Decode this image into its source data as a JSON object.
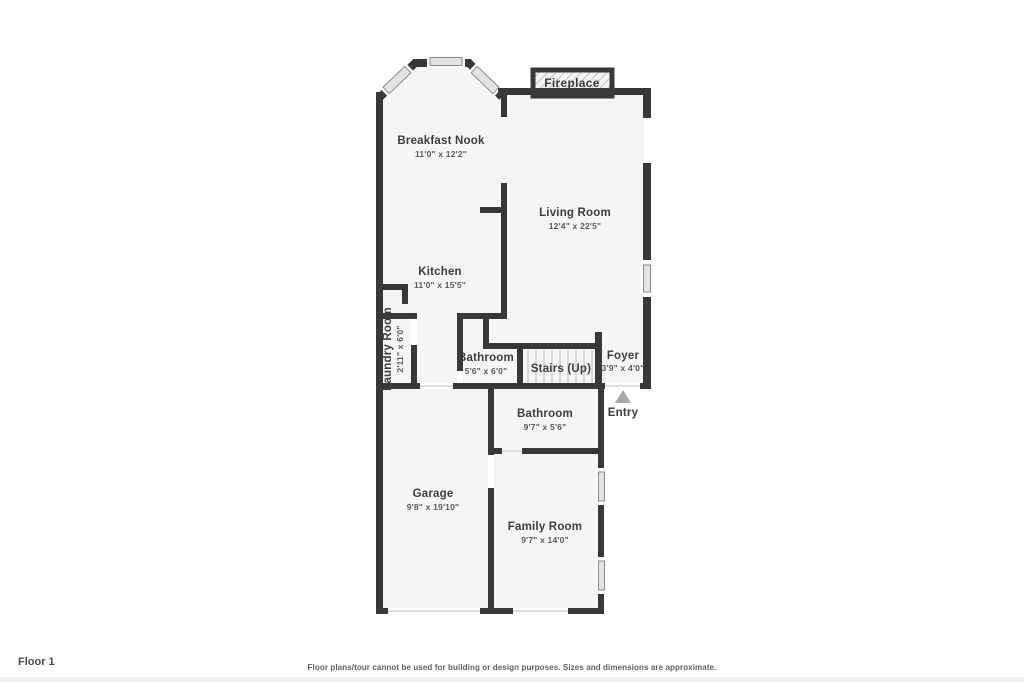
{
  "plan": {
    "floor_label": "Floor 1",
    "disclaimer": "Floor plans/tour cannot be used for building or design purposes. Sizes and dimensions are approximate.",
    "fireplace_label": "Fireplace",
    "stairs_label": "Stairs (Up)",
    "entry_label": "Entry",
    "rooms": {
      "breakfast_nook": {
        "name": "Breakfast Nook",
        "dims": "11'0\" x 12'2\""
      },
      "living_room": {
        "name": "Living Room",
        "dims": "12'4\" x 22'5\""
      },
      "kitchen": {
        "name": "Kitchen",
        "dims": "11'0\" x 15'5\""
      },
      "laundry_room": {
        "name": "Laundry Room",
        "dims": "2'11\" x 6'0\""
      },
      "bathroom_main": {
        "name": "Bathroom",
        "dims": "5'6\" x 6'0\""
      },
      "foyer": {
        "name": "Foyer",
        "dims": "3'9\" x 4'0\""
      },
      "bathroom_lower": {
        "name": "Bathroom",
        "dims": "9'7\" x 5'6\""
      },
      "garage": {
        "name": "Garage",
        "dims": "9'8\" x 19'10\""
      },
      "family_room": {
        "name": "Family Room",
        "dims": "9'7\" x 14'0\""
      }
    },
    "colors": {
      "wall": "#383838",
      "room_fill": "#f5f5f5",
      "window_fill": "#e3e3e3",
      "entry_arrow": "#a8a8a8"
    }
  }
}
